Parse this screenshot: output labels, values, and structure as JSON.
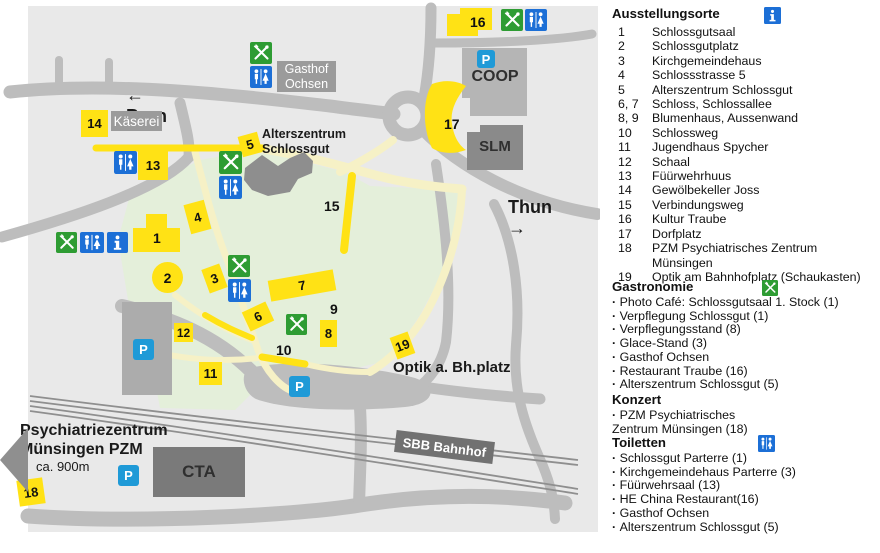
{
  "map": {
    "direction_bern": {
      "arrow": "←",
      "label": "Bern"
    },
    "direction_thun": {
      "label": "Thun",
      "arrow": "→"
    },
    "places": {
      "kaeserei": "Käserei",
      "gasthof_ochsen": "Gasthof\nOchsen",
      "alterszentrum": "Alterszentrum\nSchlossgut",
      "coop": "COOP",
      "slm": "SLM",
      "cta": "CTA",
      "sbb_bahnhof": "SBB Bahnhof",
      "optik": "Optik a. Bh.platz",
      "pzm": "Psychiatriezentrum\nMünsingen PZM",
      "pzm_distance": "ca. 900m"
    },
    "parking_label": "P",
    "markers": [
      "1",
      "2",
      "3",
      "4",
      "5",
      "6",
      "7",
      "8",
      "9",
      "10",
      "11",
      "12",
      "13",
      "14",
      "15",
      "16",
      "17",
      "18",
      "19"
    ]
  },
  "legend": {
    "exhibitions": {
      "title": "Ausstellungsorte",
      "items": [
        {
          "num": "1",
          "label": "Schlossgutsaal"
        },
        {
          "num": "2",
          "label": "Schlossgutplatz"
        },
        {
          "num": "3",
          "label": "Kirchgemeindehaus"
        },
        {
          "num": "4",
          "label": "Schlossstrasse 5"
        },
        {
          "num": "5",
          "label": "Alterszentrum Schlossgut"
        },
        {
          "num": "6, 7",
          "label": "Schloss, Schlossallee"
        },
        {
          "num": "8, 9",
          "label": "Blumenhaus, Aussenwand"
        },
        {
          "num": "10",
          "label": "Schlossweg"
        },
        {
          "num": "11",
          "label": "Jugendhaus Spycher"
        },
        {
          "num": "12",
          "label": "Schaal"
        },
        {
          "num": "13",
          "label": "Füürwehrhuus"
        },
        {
          "num": "14",
          "label": "Gewölbekeller Joss"
        },
        {
          "num": "15",
          "label": "Verbindungsweg"
        },
        {
          "num": "16",
          "label": "Kultur Traube"
        },
        {
          "num": "17",
          "label": "Dorfplatz"
        },
        {
          "num": "18",
          "label": "PZM Psychiatrisches Zentrum Münsingen"
        },
        {
          "num": "19",
          "label": "Optik am Bahnhofplatz (Schaukasten)"
        }
      ]
    },
    "gastronomy": {
      "title": "Gastronomie",
      "items": [
        "Photo Café: Schlossgutsaal  1. Stock (1)",
        "Verpflegung Schlossgut (1)",
        "Verpflegungsstand (8)",
        "Glace-Stand (3)",
        "Gasthof Ochsen",
        "Restaurant Traube (16)",
        "Alterszentrum Schlossgut (5)"
      ]
    },
    "concert": {
      "title": "Konzert",
      "items": [
        "PZM Psychiatrisches\nZentrum Münsingen (18)"
      ]
    },
    "toilets": {
      "title": "Toiletten",
      "items": [
        "Schlossgut Parterre (1)",
        "Kirchgemeindehaus Parterre (3)",
        "Füürwehrsaal (13)",
        "HE China Restaurant(16)",
        "Gasthof Ochsen",
        "Alterszentrum Schlossgut (5)"
      ]
    }
  },
  "colors": {
    "marker_yellow": "#FFE215",
    "path_pale": "#F6F1C6",
    "park_green": "#E4EFDA",
    "road_grey": "#BDBDBD",
    "restaurant_green": "#2E9C33",
    "info_wc_blue": "#1C6FD6",
    "parking_blue": "#1F9AD7"
  }
}
